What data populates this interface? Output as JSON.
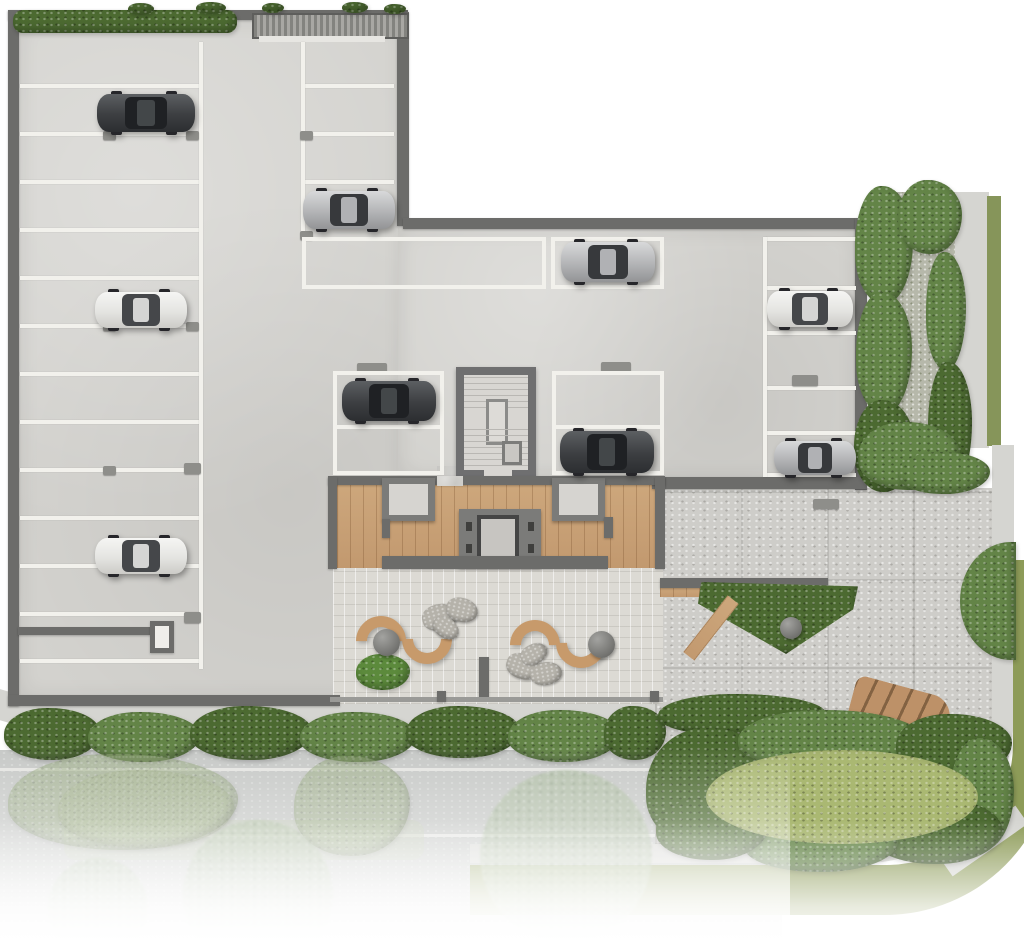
{
  "meta": {
    "type": "architectural-site-plan",
    "view": "top-down",
    "level": "ground-floor-parking",
    "text_labels": []
  },
  "summary": {
    "cars_total": 9,
    "cars_dark_gray": 3,
    "cars_silver": 3,
    "cars_white": 3,
    "left_wing_stripe_count": 13,
    "mid_column_stripe_count": 3,
    "right_column_stripe_count": 6,
    "marked_stall_boxes": 4,
    "stair_core": 1,
    "elevator_core": 1,
    "entry_vestibules": 2,
    "s_benches": 2,
    "round_planters": 3,
    "rock_clusters": 2,
    "street_trees_faded": 3
  },
  "palette": {
    "background": "#ffffff",
    "concrete": "#d3d2ce",
    "wall": "#6c6c6a",
    "stripe_white": "#f2f1ec",
    "deck_wood": "#c9a176",
    "courtyard_paver": "#dcdad4",
    "plaza_paver": "#cecdc9",
    "road": "#c6c8c6",
    "gravel": "#b6b8aa",
    "sidewalk": "#d5d5d1",
    "lawn_olive": "#8d9b58",
    "hedge_dark": "#4c6a31",
    "hedge_mid": "#638447",
    "lawn_light": "#aab872",
    "bench_wood": "#c79a6b",
    "car_dark": "#3c3e41",
    "car_silver": "#b3b4b6",
    "car_white": "#e3e3e0"
  },
  "markings": {
    "stripe_groups": [
      {
        "name": "left-wing-stripes",
        "x": 20,
        "w": 181,
        "ys": [
          84,
          132,
          180,
          228,
          276,
          324,
          372,
          420,
          468,
          516,
          564,
          612,
          659
        ]
      },
      {
        "name": "mid-column-stripes",
        "x": 305,
        "w": 89,
        "ys": [
          84,
          132,
          180
        ]
      },
      {
        "name": "right-column-stripes",
        "x": 766,
        "w": 90,
        "ys": [
          237,
          286,
          331,
          386,
          431,
          473
        ]
      }
    ],
    "vlines": [
      [
        199,
        42,
        4,
        627
      ],
      [
        301,
        42,
        4,
        192
      ],
      [
        763,
        237,
        4,
        240
      ]
    ],
    "wheel_stops": [
      [
        103,
        131
      ],
      [
        186,
        131
      ],
      [
        103,
        322
      ],
      [
        186,
        322
      ],
      [
        103,
        466
      ],
      [
        184,
        463,
        17,
        11
      ],
      [
        184,
        612,
        17,
        11
      ],
      [
        300,
        131
      ],
      [
        300,
        231
      ],
      [
        357,
        363,
        30,
        10
      ],
      [
        601,
        362,
        30,
        10
      ],
      [
        792,
        375,
        26,
        11
      ],
      [
        813,
        499,
        26,
        10
      ]
    ],
    "stall_boxes": [
      {
        "x": 302,
        "y": 237,
        "w": 244,
        "h": 52
      },
      {
        "x": 551,
        "y": 237,
        "w": 113,
        "h": 52
      },
      {
        "x": 333,
        "y": 371,
        "w": 111,
        "h": 104,
        "div": 50
      },
      {
        "x": 552,
        "y": 371,
        "w": 112,
        "h": 104,
        "div": 50
      }
    ]
  },
  "cars": [
    {
      "id": "car-1",
      "tone": "dark",
      "x": 97,
      "y": 92,
      "w": 98,
      "h": 42
    },
    {
      "id": "car-2",
      "tone": "white",
      "x": 95,
      "y": 290,
      "w": 92,
      "h": 40
    },
    {
      "id": "car-3",
      "tone": "white",
      "x": 95,
      "y": 536,
      "w": 92,
      "h": 40
    },
    {
      "id": "car-4",
      "tone": "silver",
      "x": 303,
      "y": 189,
      "w": 92,
      "h": 42
    },
    {
      "id": "car-5",
      "tone": "dark",
      "x": 342,
      "y": 379,
      "w": 94,
      "h": 44
    },
    {
      "id": "car-6",
      "tone": "silver",
      "x": 561,
      "y": 240,
      "w": 94,
      "h": 44
    },
    {
      "id": "car-7",
      "tone": "dark",
      "x": 560,
      "y": 429,
      "w": 94,
      "h": 46
    },
    {
      "id": "car-8",
      "tone": "white",
      "x": 767,
      "y": 289,
      "w": 86,
      "h": 40
    },
    {
      "id": "car-9",
      "tone": "silver",
      "x": 774,
      "y": 439,
      "w": 82,
      "h": 38
    }
  ],
  "hedges": [
    {
      "x": 13,
      "y": 10,
      "w": 224,
      "h": 23,
      "t": "dark",
      "r": "10px"
    },
    {
      "x": 128,
      "y": 3,
      "w": 26,
      "h": 12,
      "t": "dark"
    },
    {
      "x": 196,
      "y": 2,
      "w": 30,
      "h": 12,
      "t": "dark"
    },
    {
      "x": 262,
      "y": 3,
      "w": 22,
      "h": 10,
      "t": "dark"
    },
    {
      "x": 342,
      "y": 2,
      "w": 26,
      "h": 11,
      "t": "dark"
    },
    {
      "x": 384,
      "y": 4,
      "w": 22,
      "h": 10,
      "t": "dark"
    },
    {
      "x": 855,
      "y": 186,
      "w": 58,
      "h": 118,
      "t": "mid"
    },
    {
      "x": 898,
      "y": 180,
      "w": 64,
      "h": 74,
      "t": "mid"
    },
    {
      "x": 856,
      "y": 292,
      "w": 56,
      "h": 122,
      "t": "mid"
    },
    {
      "x": 854,
      "y": 400,
      "w": 60,
      "h": 92,
      "t": "dark"
    },
    {
      "x": 926,
      "y": 252,
      "w": 40,
      "h": 118,
      "t": "mid"
    },
    {
      "x": 928,
      "y": 362,
      "w": 44,
      "h": 128,
      "t": "dark"
    },
    {
      "x": 858,
      "y": 422,
      "w": 102,
      "h": 68,
      "t": "mid"
    },
    {
      "x": 898,
      "y": 452,
      "w": 92,
      "h": 42,
      "t": "mid"
    },
    {
      "x": 4,
      "y": 708,
      "w": 96,
      "h": 52,
      "t": "dark"
    },
    {
      "x": 88,
      "y": 712,
      "w": 112,
      "h": 50,
      "t": "mid"
    },
    {
      "x": 190,
      "y": 706,
      "w": 122,
      "h": 54,
      "t": "dark"
    },
    {
      "x": 300,
      "y": 712,
      "w": 116,
      "h": 50,
      "t": "mid"
    },
    {
      "x": 406,
      "y": 706,
      "w": 114,
      "h": 52,
      "t": "dark"
    },
    {
      "x": 508,
      "y": 710,
      "w": 112,
      "h": 52,
      "t": "mid"
    },
    {
      "x": 604,
      "y": 706,
      "w": 62,
      "h": 54,
      "t": "dark"
    },
    {
      "x": 658,
      "y": 694,
      "w": 168,
      "h": 42,
      "t": "dark"
    },
    {
      "x": 646,
      "y": 728,
      "w": 132,
      "h": 122,
      "t": "dark"
    },
    {
      "x": 738,
      "y": 710,
      "w": 184,
      "h": 60,
      "t": "mid"
    },
    {
      "x": 896,
      "y": 714,
      "w": 116,
      "h": 62,
      "t": "dark"
    },
    {
      "x": 950,
      "y": 738,
      "w": 64,
      "h": 112,
      "t": "mid"
    },
    {
      "x": 870,
      "y": 798,
      "w": 132,
      "h": 66,
      "t": "dark"
    },
    {
      "x": 744,
      "y": 814,
      "w": 154,
      "h": 58,
      "t": "mid"
    },
    {
      "x": 656,
      "y": 798,
      "w": 112,
      "h": 62,
      "t": "dark"
    },
    {
      "x": 706,
      "y": 750,
      "w": 272,
      "h": 94,
      "t": "light",
      "r": "50%"
    },
    {
      "x": 960,
      "y": 542,
      "w": 56,
      "h": 118,
      "t": "mid",
      "r": "100% 0 0 100% / 55% 0 0 55%"
    },
    {
      "x": 8,
      "y": 754,
      "w": 230,
      "h": 96,
      "t": "faded"
    },
    {
      "x": 294,
      "y": 756,
      "w": 116,
      "h": 100,
      "t": "faded"
    },
    {
      "x": 58,
      "y": 770,
      "w": 176,
      "h": 78,
      "t": "faded2"
    }
  ],
  "trees": [
    {
      "x": 183,
      "y": 820,
      "d": 150
    },
    {
      "x": 480,
      "y": 770,
      "d": 172
    },
    {
      "x": 48,
      "y": 858,
      "d": 100
    }
  ],
  "furniture": {
    "benches": [
      {
        "x": 354,
        "y": 612
      },
      {
        "x": 508,
        "y": 616
      }
    ],
    "planters": [
      {
        "x": 373,
        "y": 629,
        "d": 27
      },
      {
        "x": 588,
        "y": 631,
        "d": 27
      },
      {
        "x": 780,
        "y": 617,
        "d": 22
      }
    ],
    "rock_clusters": [
      {
        "x": 422,
        "y": 598,
        "stones": [
          [
            0,
            6,
            36,
            26,
            -15
          ],
          [
            24,
            0,
            32,
            24,
            12
          ],
          [
            10,
            20,
            28,
            20,
            32
          ]
        ]
      },
      {
        "x": 506,
        "y": 644,
        "stones": [
          [
            0,
            10,
            34,
            25,
            18
          ],
          [
            24,
            18,
            32,
            23,
            -10
          ],
          [
            14,
            0,
            28,
            20,
            -28
          ]
        ]
      }
    ]
  }
}
